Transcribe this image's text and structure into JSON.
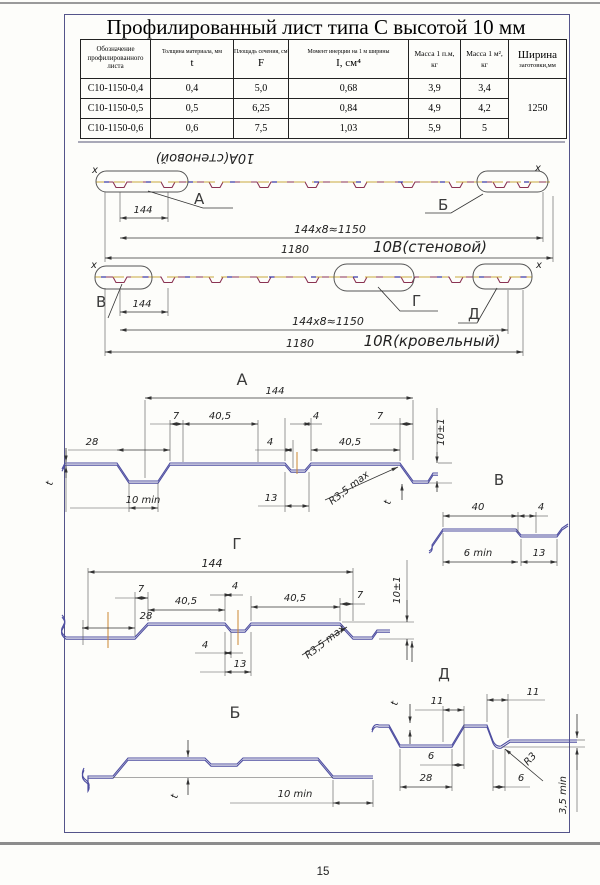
{
  "page": {
    "number": "15"
  },
  "title": "Профилированный лист типа С высотой 10 мм",
  "table": {
    "headers": {
      "designation": "Обозначение профилированного листа",
      "thickness_top": "Толщина материала, мм",
      "thickness_sym": "t",
      "area_top": "Площадь сечения, см²",
      "area_sym": "F",
      "inertia_top": "Момент инерции на 1 м ширины",
      "inertia_sym": "I, см⁴",
      "mass_lm_top": "Масса 1 п.м,",
      "mass_lm_unit": "кг",
      "mass_m2_top": "Масса 1 м²,",
      "mass_m2_unit": "кг",
      "width_top": "Ширина",
      "width_bottom": "заготовки,мм"
    },
    "rows": [
      {
        "designation": "С10-1150-0,4",
        "t": "0,4",
        "F": "5,0",
        "I": "0,68",
        "mass_lm": "3,9",
        "mass_m2": "3,4"
      },
      {
        "designation": "С10-1150-0,5",
        "t": "0,5",
        "F": "6,25",
        "I": "0,84",
        "mass_lm": "4,9",
        "mass_m2": "4,2"
      },
      {
        "designation": "С10-1150-0,6",
        "t": "0,6",
        "F": "7,5",
        "I": "1,03",
        "mass_lm": "5,9",
        "mass_m2": "5"
      }
    ],
    "blank_width": "1250"
  },
  "ov1": {
    "flipped": "10А(стеновой)",
    "x_left": "x",
    "x_right": "x",
    "a": "А",
    "b": "Б",
    "d144": "144",
    "pitch": "144x8≈1150",
    "d1180": "1180",
    "name": "10В(стеновой)"
  },
  "ov2": {
    "x_left": "x",
    "x_right": "x",
    "v": "В",
    "g": "Г",
    "d": "Д",
    "d144": "144",
    "pitch": "144x8≈1150",
    "d1180": "1180",
    "name": "10R(кровельный)"
  },
  "dA": {
    "t": "А",
    "d144": "144",
    "d7": "7",
    "d405": "40,5",
    "d4": "4",
    "d28": "28",
    "d10min": "10 min",
    "d13": "13",
    "r": "R3,5 max",
    "h": "10±1",
    "th": "t"
  },
  "dV": {
    "t": "В",
    "d40": "40",
    "d4": "4",
    "d6min": "6 min",
    "d13": "13"
  },
  "dG": {
    "t": "Г",
    "d144": "144",
    "d7": "7",
    "d405": "40,5",
    "d4": "4",
    "d28": "28",
    "d13": "13",
    "r": "R3,5 max",
    "h": "10±1"
  },
  "dB": {
    "t": "Б",
    "th": "t",
    "d10min": "10 min"
  },
  "dD": {
    "t": "Д",
    "th": "t",
    "d11": "11",
    "d6": "6",
    "d28": "28",
    "r": "R3",
    "d35": "3,5 min"
  }
}
